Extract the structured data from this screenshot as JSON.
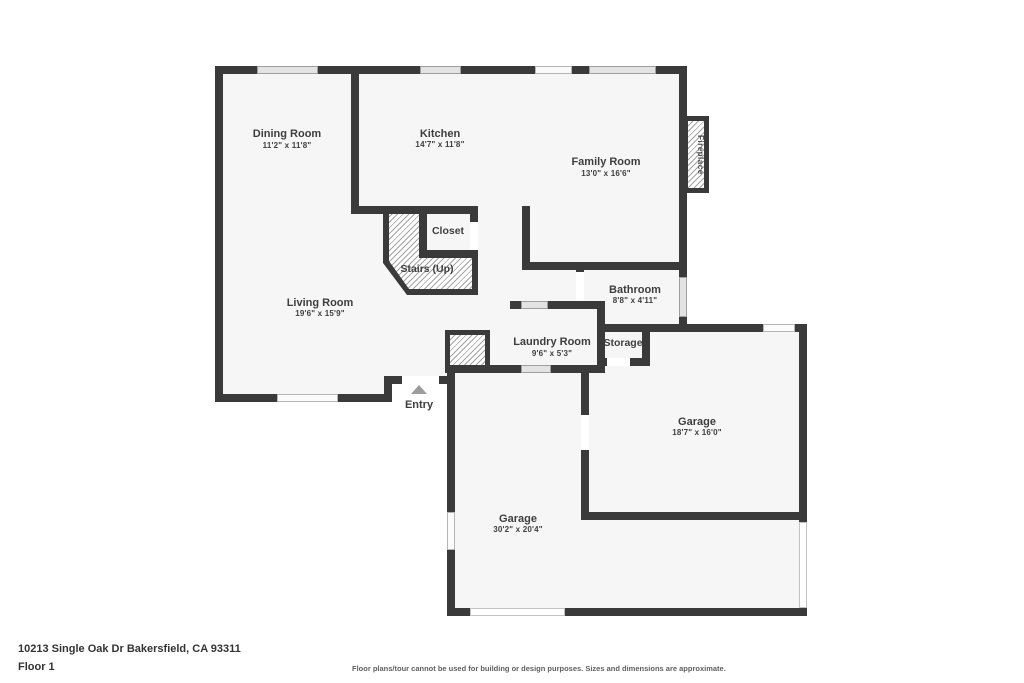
{
  "plan": {
    "rooms": [
      {
        "id": "dining",
        "name": "Dining Room",
        "dims": "11'2\" x 11'8\""
      },
      {
        "id": "kitchen",
        "name": "Kitchen",
        "dims": "14'7\" x 11'8\""
      },
      {
        "id": "family",
        "name": "Family Room",
        "dims": "13'0\" x 16'6\""
      },
      {
        "id": "closet",
        "name": "Closet",
        "dims": ""
      },
      {
        "id": "stairs",
        "name": "Stairs (Up)",
        "dims": ""
      },
      {
        "id": "living",
        "name": "Living Room",
        "dims": "19'6\" x 15'9\""
      },
      {
        "id": "bathroom",
        "name": "Bathroom",
        "dims": "8'8\" x 4'11\""
      },
      {
        "id": "laundry",
        "name": "Laundry Room",
        "dims": "9'6\" x 5'3\""
      },
      {
        "id": "storage",
        "name": "Storage",
        "dims": ""
      },
      {
        "id": "garage_rear",
        "name": "Garage",
        "dims": "18'7\" x 16'0\""
      },
      {
        "id": "garage_main",
        "name": "Garage",
        "dims": "30'2\" x 20'4\""
      },
      {
        "id": "entry",
        "name": "Entry",
        "dims": ""
      },
      {
        "id": "fireplace",
        "name": "Fireplace",
        "dims": ""
      }
    ],
    "footer": {
      "address": "10213 Single Oak Dr Bakersfield, CA 93311",
      "floor_label": "Floor 1",
      "disclaimer": "Floor plans/tour cannot be used for building or design purposes. Sizes and dimensions are approximate."
    },
    "colors": {
      "wall": "#3a3a3a",
      "floor": "#f6f6f6",
      "text": "#3e3e3e"
    }
  }
}
